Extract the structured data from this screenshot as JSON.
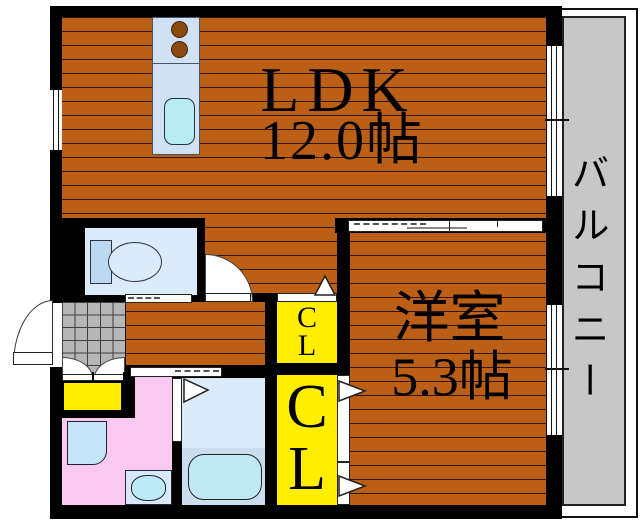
{
  "rooms": {
    "ldk": {
      "label": "LDK",
      "size": "12.0帖"
    },
    "western": {
      "label": "洋室",
      "size": "5.3帖"
    },
    "balcony": {
      "label": "バルコニー"
    }
  },
  "closets": {
    "small": {
      "lines": [
        "C",
        "L"
      ]
    },
    "large": {
      "lines": [
        "C",
        "L"
      ]
    }
  },
  "fixtures": {
    "stove_burners_icon": "two brown circles",
    "kitchen_sink_icon": "rounded cyan rectangle",
    "toilet_icon": "tank rectangle with oval bowl",
    "bathtub_icon": "rounded rectangle tub",
    "washbasin_icon": "oval basin in box",
    "washing_machine_pan_icon": "rounded square pan",
    "shoe_cabinet_icon": "yellow box",
    "door_swing_icon": "white quarter-circle arc",
    "sliding_door_icon": "white strip with dashed track",
    "door_direction_icon": "white outlined triangle",
    "window_icon": "white double-line strip in wall"
  },
  "colors": {
    "wall": "#000000",
    "wood_floor": "#bc5f16",
    "balcony_floor": "#c7c7c7",
    "entrance_tile": "#b6b6b6",
    "closet_yellow": "#ffee00",
    "washroom_pink": "#f9c9ef",
    "fixture_blue": "#dcebf9",
    "text": "#000000"
  }
}
